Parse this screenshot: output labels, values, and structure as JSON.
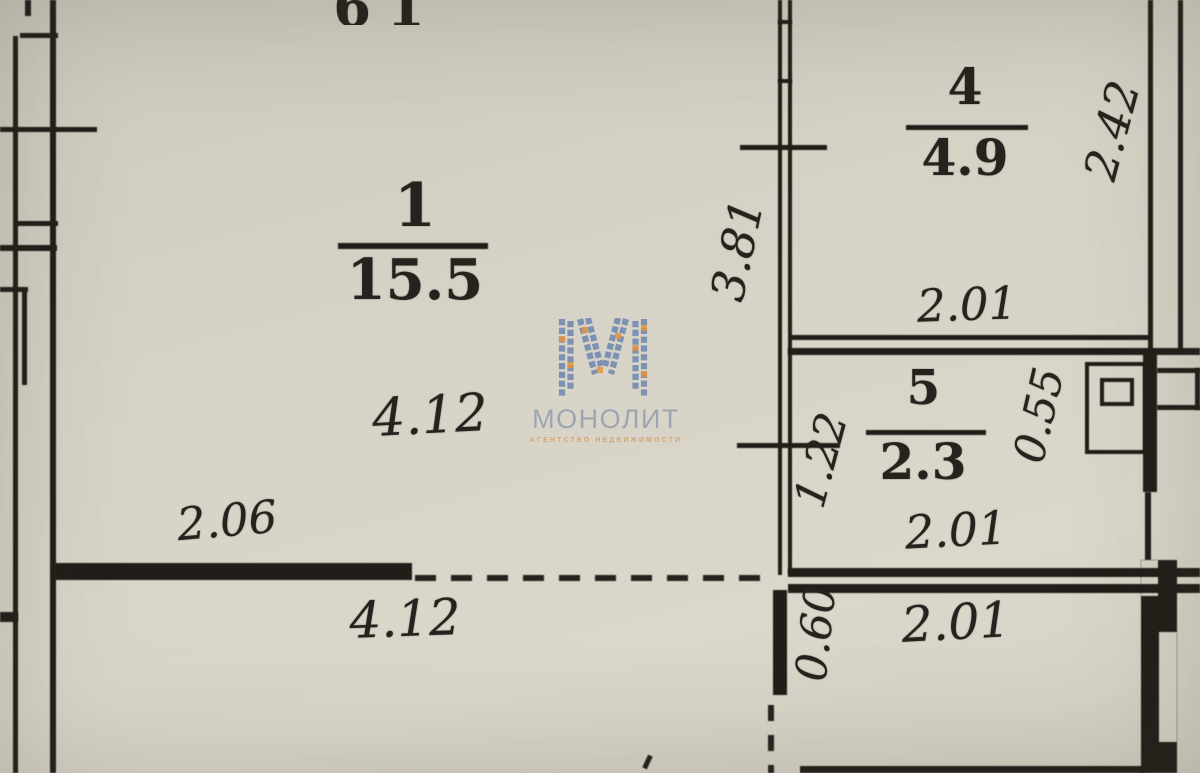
{
  "plan": {
    "top_partial_text": "61",
    "rooms": {
      "r1": {
        "number": "1",
        "area": "15.5"
      },
      "r4": {
        "number": "4",
        "area": "4.9"
      },
      "r5": {
        "number": "5",
        "area": "2.3"
      }
    },
    "dims": {
      "room1_width_top": "4.12",
      "room1_wall_segment": "2.06",
      "room1_width_bottom": "4.12",
      "corridor_height": "3.81",
      "corridor_lower": "1.22",
      "room4_height": "2.42",
      "room4_width": "2.01",
      "shaft_height": "0.55",
      "room5_width": "2.01",
      "lower_wall_height": "0.60",
      "lower_room_width": "2.01"
    },
    "watermark": {
      "brand": "МОНОЛИТ",
      "subtitle": "АГЕНТСТВО НЕДВИЖИМОСТИ"
    },
    "colors": {
      "paper": "#d7d3c7",
      "ink": "#23201c",
      "logo_blue": "#6580ae",
      "logo_orange": "#e2933f",
      "brand_text": "#939db0",
      "subtitle_text": "#d39a5f"
    }
  }
}
